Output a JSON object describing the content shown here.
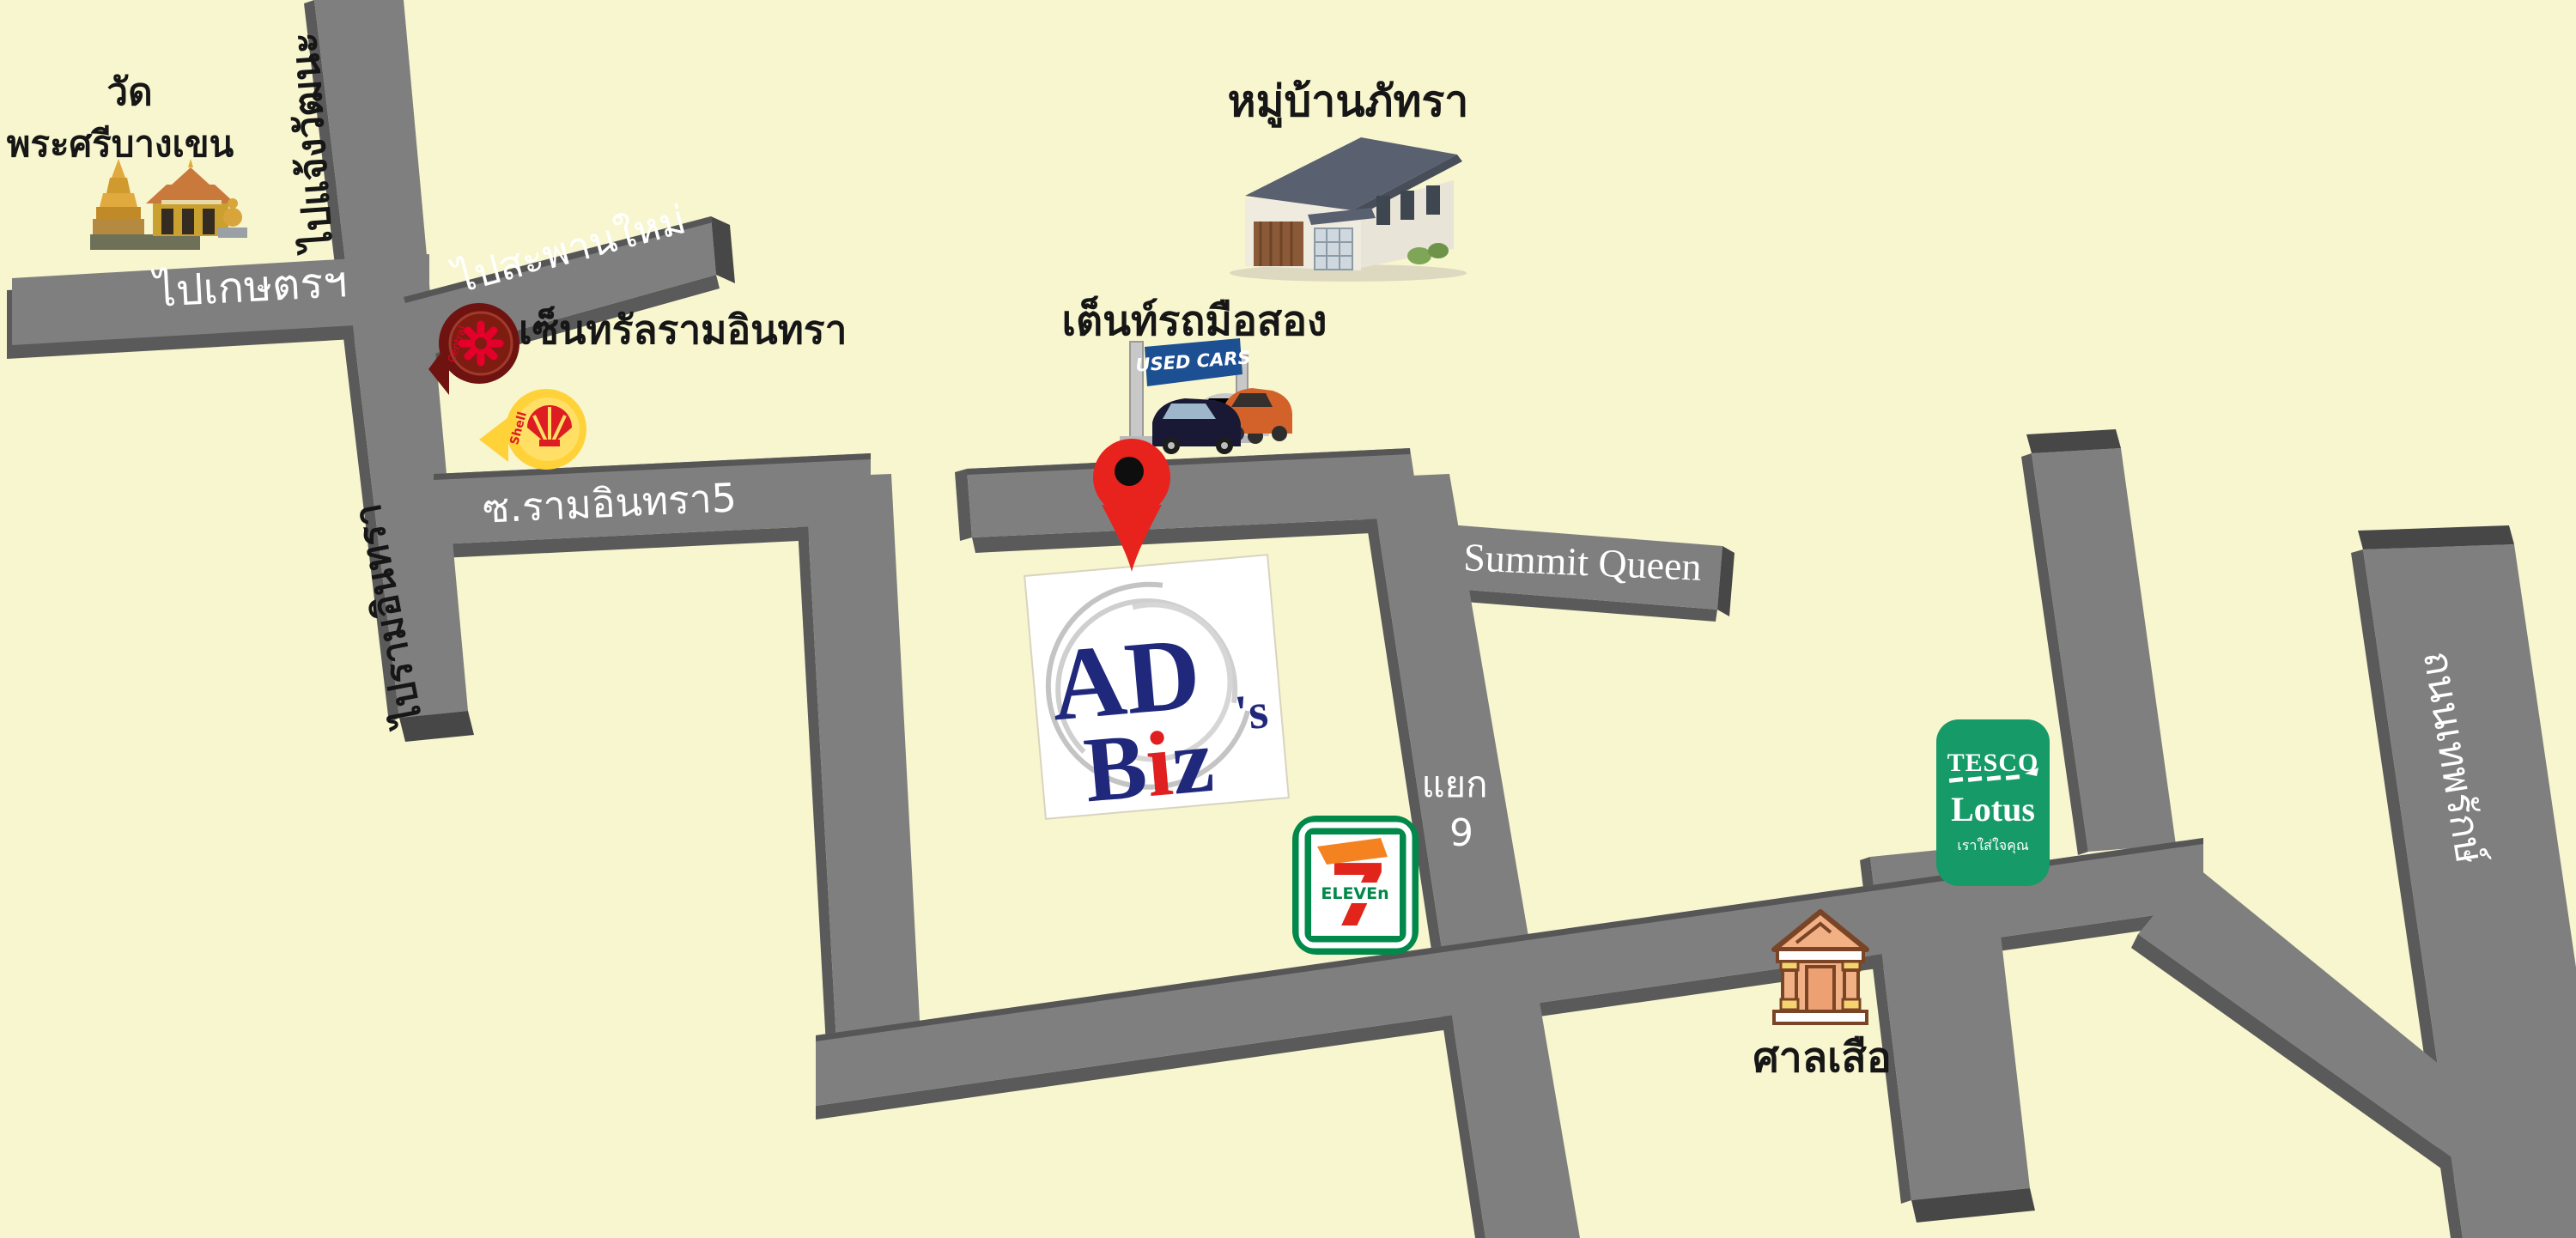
{
  "colors": {
    "background": "#f8f6cf",
    "road": "#7f7f7f",
    "road_shadow": "#5a5a5a",
    "road_cap": "#474747",
    "pin_red": "#e8231d",
    "seven_green": "#00894a",
    "seven_red": "#e1251b",
    "seven_orange": "#f58220",
    "tesco_green": "#169a68",
    "shell_yellow": "#ffd23a",
    "shell_red": "#dd1d21",
    "central_maroon": "#6f1310",
    "banner_blue": "#1d4f93",
    "logo_navy": "#20287c",
    "logo_red": "#e02020"
  },
  "labels": {
    "temple_line1": "วัด",
    "temple_line2": "พระศรีบางเขน",
    "to_kaset": "ไปเกษตรฯ",
    "to_saphanmai": "ไปสะพานใหม่",
    "to_chaengwattana": "ไปแจ้งวัฒนะ",
    "to_ramindra": "ไปรามอินทรา",
    "central": "เซ็นทรัลรามอินทรา",
    "central_logo": "Central",
    "shell_logo": "Shell",
    "soi_ramindra5": "ซ.รามอินทรา5",
    "village": "หมู่บ้านภัทรา",
    "used_car_tent": "เต็นท์รถมือสอง",
    "used_cars_banner": "USED CARS",
    "summit_queen": "Summit Queen",
    "junction": "แยก",
    "junction_no": "9",
    "seven": "7",
    "eleven": "ELEVEn",
    "tesco": "TESCO",
    "lotus": "Lotus",
    "tesco_tagline": "เราใส่ใจคุณ",
    "tiger_shrine": "ศาลเสือ",
    "far_right_road": "ถนนเทพรักษ์",
    "adsbiz_ad": "AD",
    "adsbiz_s": "'s",
    "adsbiz_b": "B",
    "adsbiz_i": "i",
    "adsbiz_z": "z"
  }
}
